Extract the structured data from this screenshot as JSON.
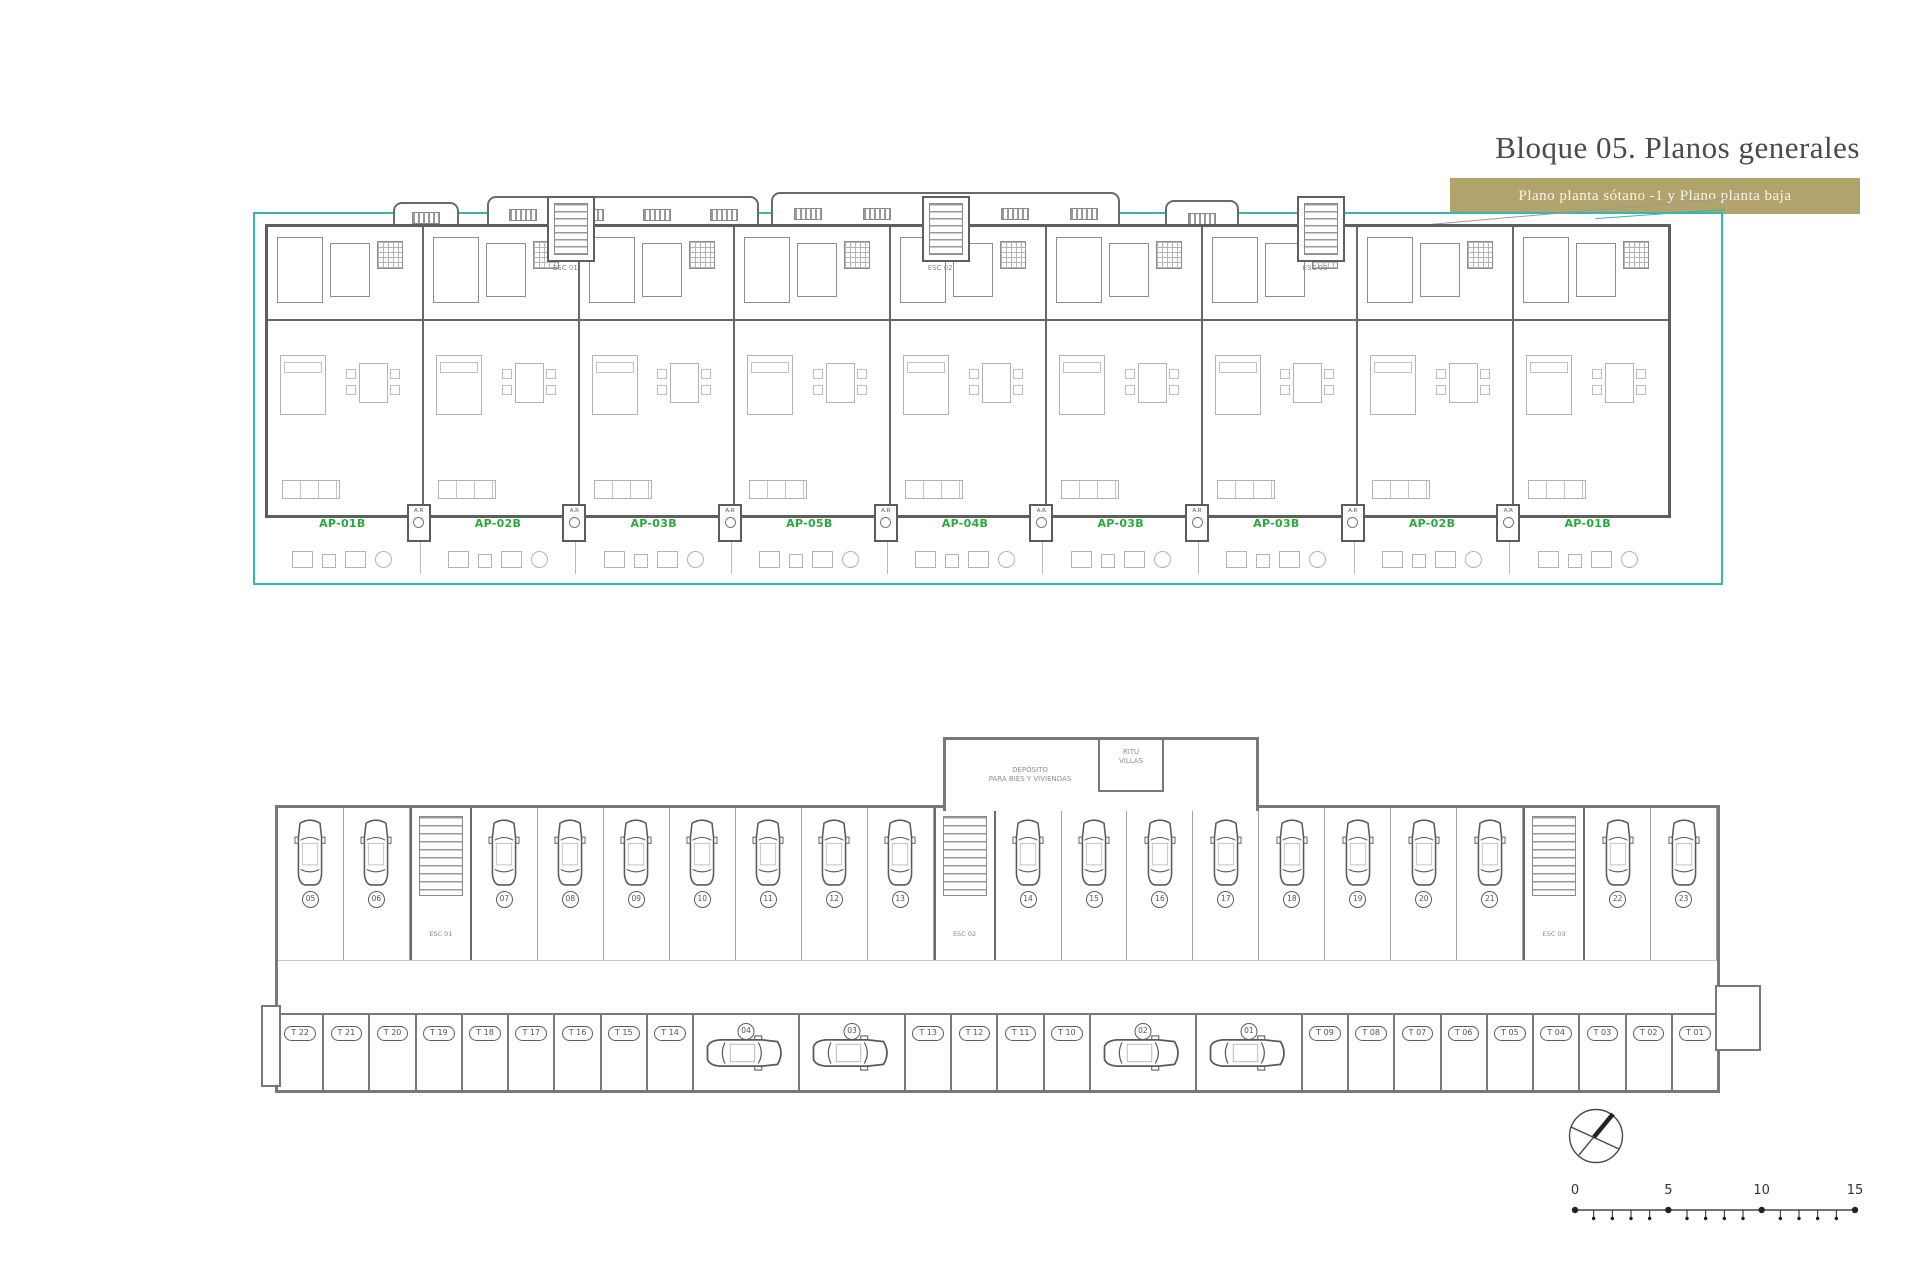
{
  "header": {
    "title": "Bloque 05. Planos generales",
    "subtitle": "Plano planta sótano -1 y Plano planta baja",
    "banner_color": "#b2a26b",
    "title_color": "#4a4a4a"
  },
  "colors": {
    "boundary_teal": "#35b6ae",
    "apartment_green": "#28ab39",
    "wall_gray": "#5f5f5f",
    "furniture_gray": "#b3b3b3"
  },
  "floor_plan": {
    "name": "Plano planta baja",
    "apartments": [
      {
        "label": "AP-01B"
      },
      {
        "label": "AP-02B"
      },
      {
        "label": "AP-03B"
      },
      {
        "label": "AP-05B"
      },
      {
        "label": "AP-04B"
      },
      {
        "label": "AP-03B"
      },
      {
        "label": "AP-03B"
      },
      {
        "label": "AP-02B"
      },
      {
        "label": "AP-01B"
      }
    ],
    "stairs": [
      "ESC 01",
      "ESC 02",
      "ESC 03"
    ],
    "ar_label": "A.R"
  },
  "basement": {
    "name": "Plano planta sótano -1",
    "deposit_line1": "DEPÓSITO",
    "deposit_line2": "PARA BIES Y VIVIENDAS",
    "ritu_line1": "RITU",
    "ritu_line2": "VILLAS",
    "parking_row": [
      {
        "type": "stall",
        "num": "05"
      },
      {
        "type": "stall",
        "num": "06"
      },
      {
        "type": "core",
        "label": "ESC 01"
      },
      {
        "type": "stall",
        "num": "07"
      },
      {
        "type": "stall",
        "num": "08"
      },
      {
        "type": "stall",
        "num": "09"
      },
      {
        "type": "stall",
        "num": "10"
      },
      {
        "type": "stall",
        "num": "11"
      },
      {
        "type": "stall",
        "num": "12"
      },
      {
        "type": "stall",
        "num": "13"
      },
      {
        "type": "core",
        "label": "ESC 02"
      },
      {
        "type": "stall",
        "num": "14"
      },
      {
        "type": "stall",
        "num": "15"
      },
      {
        "type": "stall",
        "num": "16"
      },
      {
        "type": "stall",
        "num": "17"
      },
      {
        "type": "stall",
        "num": "18"
      },
      {
        "type": "stall",
        "num": "19"
      },
      {
        "type": "stall",
        "num": "20"
      },
      {
        "type": "stall",
        "num": "21"
      },
      {
        "type": "core",
        "label": "ESC 03"
      },
      {
        "type": "stall",
        "num": "22"
      },
      {
        "type": "stall",
        "num": "23"
      }
    ],
    "storage_row": [
      {
        "type": "storage",
        "label": "T 22"
      },
      {
        "type": "storage",
        "label": "T 21"
      },
      {
        "type": "storage",
        "label": "T 20"
      },
      {
        "type": "storage",
        "label": "T 19"
      },
      {
        "type": "storage",
        "label": "T 18"
      },
      {
        "type": "storage",
        "label": "T 17"
      },
      {
        "type": "storage",
        "label": "T 16"
      },
      {
        "type": "storage",
        "label": "T 15"
      },
      {
        "type": "storage",
        "label": "T 14"
      },
      {
        "type": "car",
        "num": "04"
      },
      {
        "type": "car",
        "num": "03"
      },
      {
        "type": "storage",
        "label": "T 13"
      },
      {
        "type": "storage",
        "label": "T 12"
      },
      {
        "type": "storage",
        "label": "T 11"
      },
      {
        "type": "storage",
        "label": "T 10"
      },
      {
        "type": "car",
        "num": "02"
      },
      {
        "type": "car",
        "num": "01"
      },
      {
        "type": "storage",
        "label": "T 09"
      },
      {
        "type": "storage",
        "label": "T 08"
      },
      {
        "type": "storage",
        "label": "T 07"
      },
      {
        "type": "storage",
        "label": "T 06"
      },
      {
        "type": "storage",
        "label": "T 05"
      },
      {
        "type": "storage",
        "label": "T 04"
      },
      {
        "type": "storage",
        "label": "T 03"
      },
      {
        "type": "storage",
        "label": "T 02"
      },
      {
        "type": "storage",
        "label": "T 01"
      }
    ]
  },
  "scale_bar": {
    "unit_labels": [
      "0",
      "5",
      "10",
      "15"
    ],
    "total_units": 15
  }
}
